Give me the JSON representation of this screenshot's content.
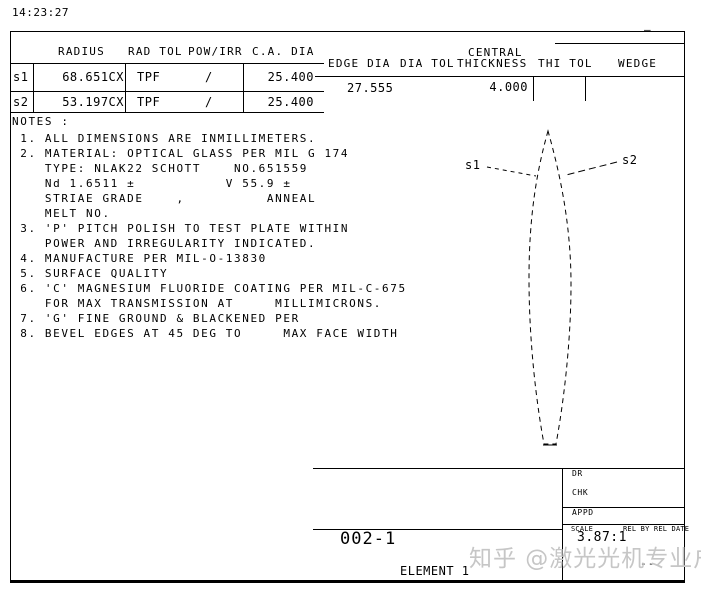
{
  "meta": {
    "timestamp": "14:23:27"
  },
  "surface_table": {
    "headers": {
      "radius": "RADIUS",
      "rad_tol": "RAD TOL",
      "pow_irr": "POW/IRR",
      "ca_dia": "C.A. DIA"
    },
    "rows": [
      {
        "id": "s1",
        "radius": "68.651CX",
        "rad_tol": "TPF",
        "pow_irr": "/",
        "ca_dia": "25.400"
      },
      {
        "id": "s2",
        "radius": "53.197CX",
        "rad_tol": "TPF",
        "pow_irr": "/",
        "ca_dia": "25.400"
      }
    ]
  },
  "dim_table": {
    "headers": {
      "edge_dia": "EDGE DIA",
      "dia_tol": "DIA TOL",
      "central_line1": "CENTRAL",
      "central_line2": "THICKNESS",
      "thi_tol": "THI TOL",
      "wedge": "WEDGE"
    },
    "values": {
      "edge_dia": "27.555",
      "central_thickness": "4.000"
    },
    "rev_mark": "—"
  },
  "notes": {
    "title": "NOTES :",
    "lines": [
      " 1. ALL DIMENSIONS ARE INMILLIMETERS.",
      " 2. MATERIAL: OPTICAL GLASS PER MIL G 174",
      "    TYPE: NLAK22 SCHOTT    NO.651559",
      "    Nd 1.6511 ±           V 55.9 ±",
      "    STRIAE GRADE    ,          ANNEAL",
      "    MELT NO.",
      " 3. 'P' PITCH POLISH TO TEST PLATE WITHIN",
      "    POWER AND IRREGULARITY INDICATED.",
      " 4. MANUFACTURE PER MIL-O-13830",
      " 5. SURFACE QUALITY",
      " 6. 'C' MAGNESIUM FLUORIDE COATING PER MIL-C-675",
      "    FOR MAX TRANSMISSION AT     MILLIMICRONS.",
      " 7. 'G' FINE GROUND & BLACKENED PER",
      " 8. BEVEL EDGES AT 45 DEG TO     MAX FACE WIDTH"
    ]
  },
  "drawing": {
    "s1_label": "s1",
    "s2_label": "s2"
  },
  "title_block": {
    "dr_label": "DR",
    "chk_label": "CHK",
    "appd_label": "APPD",
    "scale_label": "SCALE",
    "scale_value": "3.87:1",
    "rel_label": "REL BY REL DATE",
    "dash_mark": "--",
    "part_number": "002-1",
    "element_label": "ELEMENT 1"
  },
  "watermark": {
    "text": "知乎 @激光光机专业户",
    "color": "#c6c6c6"
  }
}
